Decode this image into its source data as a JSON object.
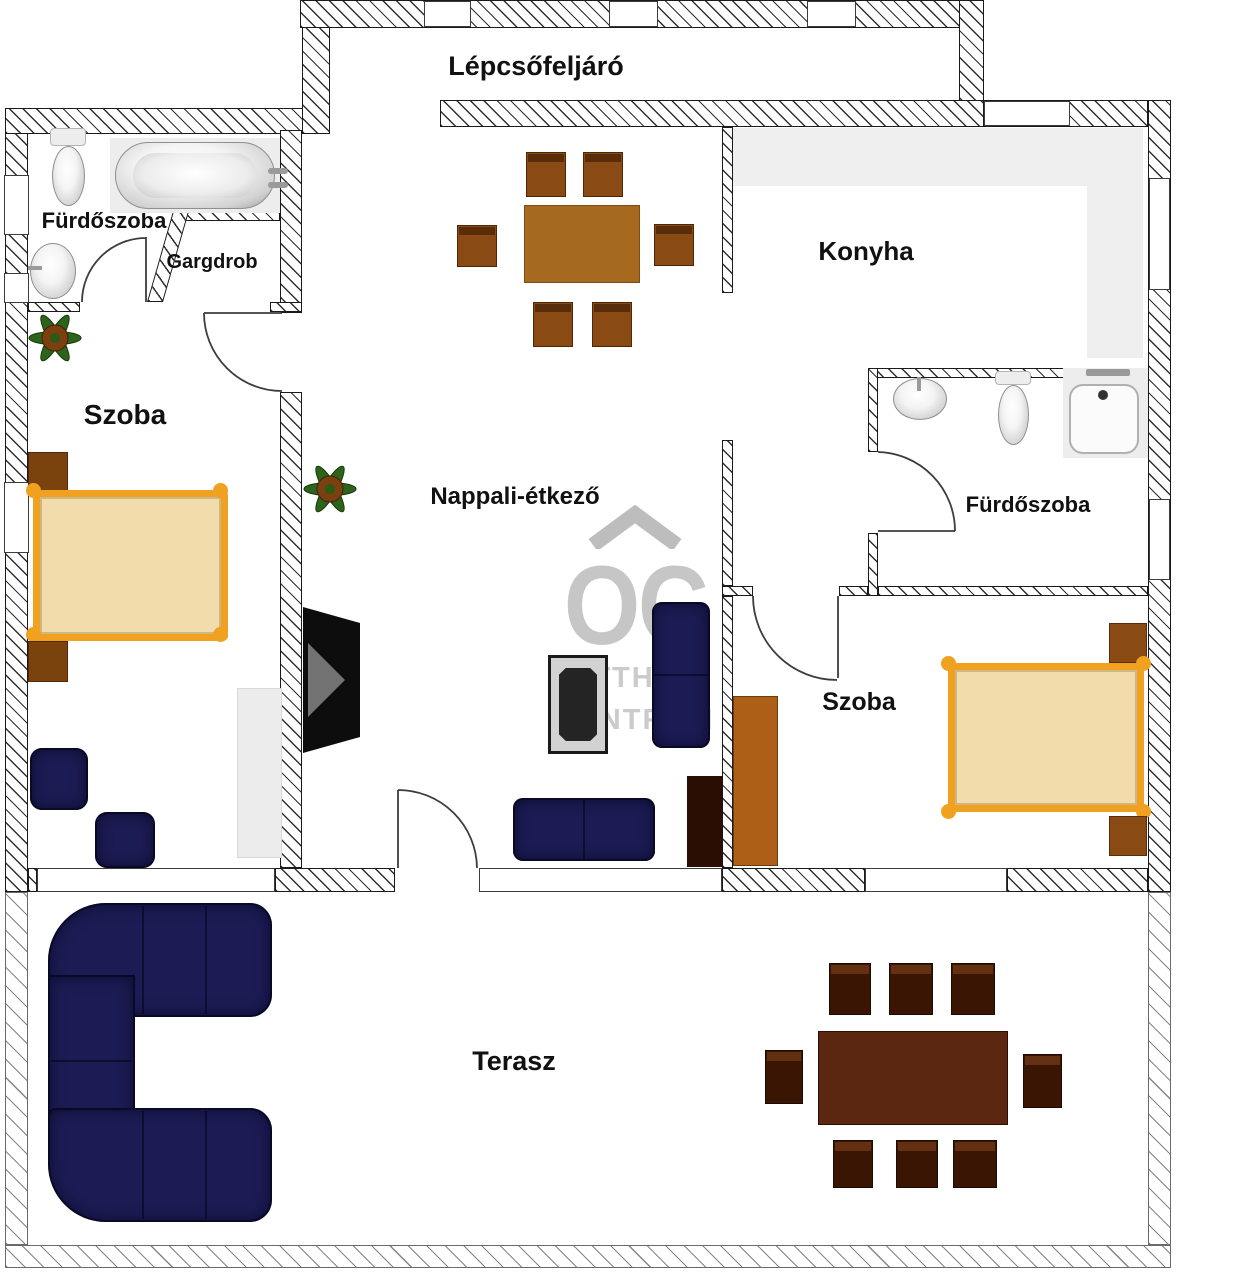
{
  "title": "Lakás alaprajz",
  "rooms": {
    "staircase": {
      "label": "Lépcsőfeljáró"
    },
    "bathroom1": {
      "label": "Fürdőszoba"
    },
    "wardrobe_room": {
      "label": "Gargdrob"
    },
    "bedroom1": {
      "label": "Szoba"
    },
    "kitchen": {
      "label": "Konyha"
    },
    "living": {
      "label": "Nappali-étkező"
    },
    "bathroom2": {
      "label": "Fürdőszoba"
    },
    "bedroom2": {
      "label": "Szoba"
    },
    "terrace": {
      "label": "Terasz"
    }
  },
  "watermark": {
    "logo": "OC",
    "line1": "OTTHON",
    "line2": "CENTRUM"
  },
  "furniture": {
    "living": [
      "dining-table",
      "6 chairs",
      "tv",
      "coffee-table",
      "sofa",
      "sofa",
      "cabinet",
      "plant"
    ],
    "bedroom1": [
      "double-bed",
      "2 nightstands",
      "2 armchairs",
      "closet",
      "plant"
    ],
    "bedroom2": [
      "double-bed",
      "2 nightstands",
      "wardrobe"
    ],
    "bathroom1": [
      "toilet",
      "bathtub",
      "sink"
    ],
    "bathroom2": [
      "sink",
      "toilet",
      "shower-tray"
    ],
    "terrace": [
      "corner-sofa",
      "dining-table",
      "8 chairs"
    ]
  },
  "colors": {
    "label": "#111111",
    "counter": "#efefef",
    "navy": "#1c1c54",
    "bed-frame": "#f0a11f",
    "bed-fill": "#f3dcab",
    "wood-mid": "#8a4a13",
    "wood-light": "#a5691f",
    "wood-dark": "#3a1504",
    "wood-table-dark": "#5b2710",
    "cabinet-dark": "#2a0e04",
    "wardrobe-orange": "#ad5f17",
    "nightstand": "#7a430e",
    "closet-gray": "#ececec",
    "watermark": "#c6c6c6",
    "plant-green": "#2d641c",
    "pot-brown": "#7a4012"
  }
}
